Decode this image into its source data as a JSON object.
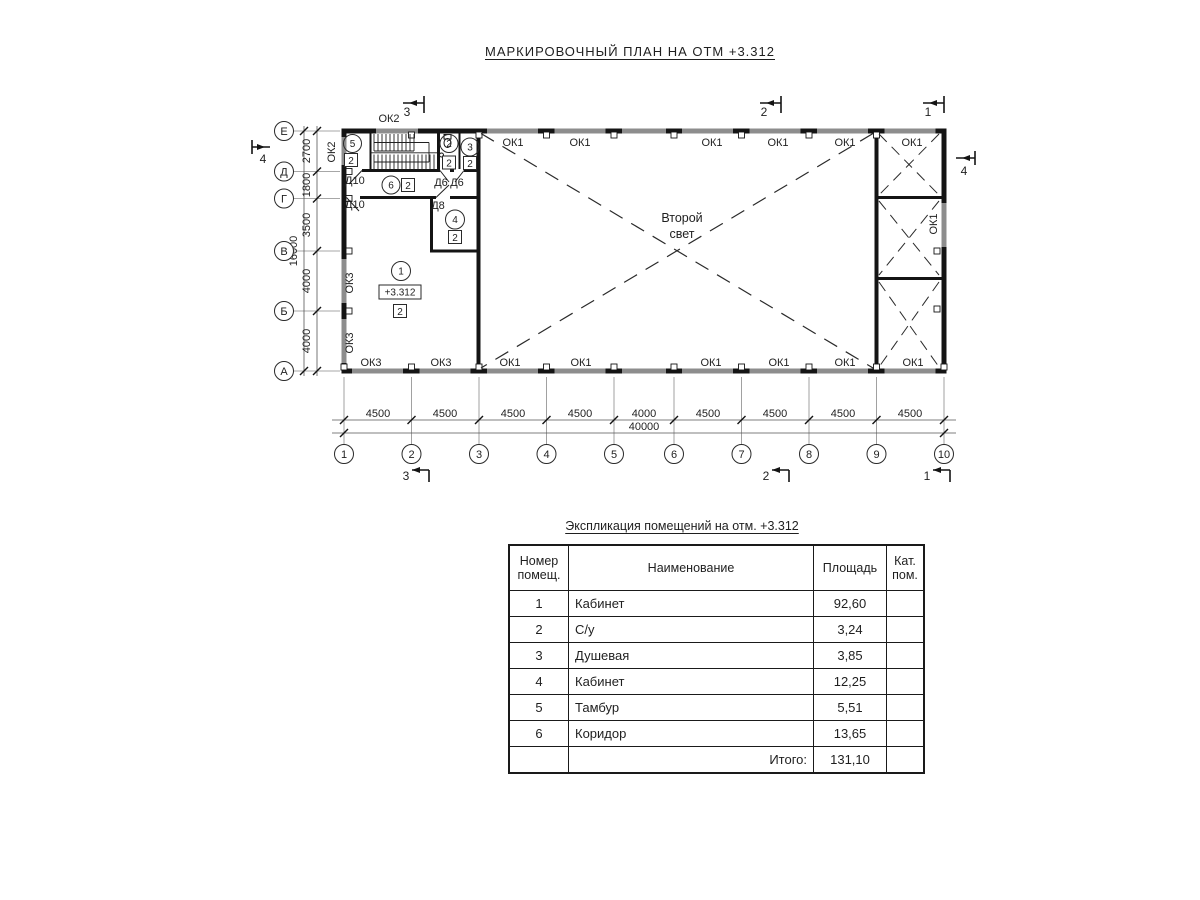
{
  "title": "МАРКИРОВОЧНЫЙ ПЛАН НА ОТМ +3.312",
  "plan": {
    "second_light_1": "Второй",
    "second_light_2": "свет",
    "elevation": "+3.312",
    "finish": "2",
    "windows_top": [
      "ОК2",
      "ОК1",
      "ОК1",
      "ОК1",
      "ОК1",
      "ОК1",
      "ОК1"
    ],
    "windows_bottom": [
      "ОК3",
      "ОК3",
      "ОК1",
      "ОК1",
      "ОК1",
      "ОК1",
      "ОК1",
      "ОК1"
    ],
    "windows_left": [
      "ОК2",
      "ОК3",
      "ОК3"
    ],
    "window_right": "ОК1",
    "doors": [
      "Д10",
      "Д6",
      "Д6",
      "Д10",
      "Д8"
    ],
    "room_numbers": [
      "1",
      "2",
      "3",
      "4",
      "5",
      "6"
    ],
    "dims_bottom": [
      "4500",
      "4500",
      "4500",
      "4500",
      "4000",
      "4500",
      "4500",
      "4500",
      "4500"
    ],
    "dim_bottom_total": "40000",
    "dims_left": [
      "2700",
      "1800",
      "3500",
      "4000",
      "4000"
    ],
    "dim_left_total": "16000",
    "grid_cols": [
      "1",
      "2",
      "3",
      "4",
      "5",
      "6",
      "7",
      "8",
      "9",
      "10"
    ],
    "grid_rows": [
      "Е",
      "Д",
      "Г",
      "В",
      "Б",
      "А"
    ],
    "sections": [
      "1",
      "2",
      "3",
      "4"
    ]
  },
  "table": {
    "title": "Экспликация помещений на отм. +3.312",
    "header": {
      "num1": "Номер",
      "num2": "помещ.",
      "name": "Наименование",
      "area": "Площадь",
      "cat1": "Кат.",
      "cat2": "пом."
    },
    "rows": [
      {
        "num": "1",
        "name": "Кабинет",
        "area": "92,60",
        "cat": ""
      },
      {
        "num": "2",
        "name": "С/у",
        "area": "3,24",
        "cat": ""
      },
      {
        "num": "3",
        "name": "Душевая",
        "area": "3,85",
        "cat": ""
      },
      {
        "num": "4",
        "name": "Кабинет",
        "area": "12,25",
        "cat": ""
      },
      {
        "num": "5",
        "name": "Тамбур",
        "area": "5,51",
        "cat": ""
      },
      {
        "num": "6",
        "name": "Коридор",
        "area": "13,65",
        "cat": ""
      }
    ],
    "total_label": "Итого:",
    "total_area": "131,10"
  }
}
